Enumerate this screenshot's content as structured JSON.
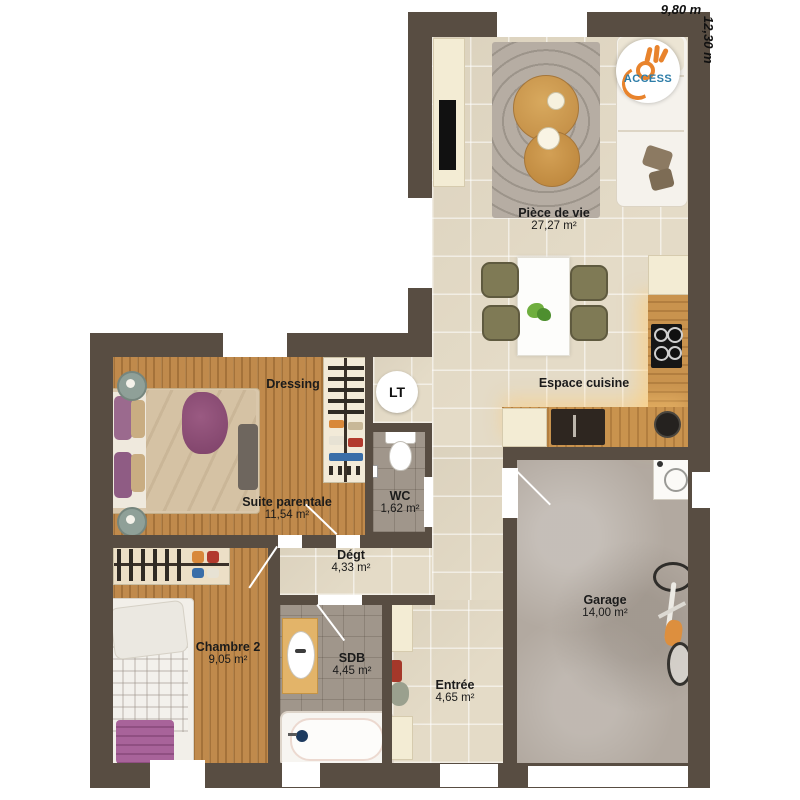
{
  "dimensions": {
    "width_label": "9,80 m",
    "height_label": "12,30 m"
  },
  "logo": {
    "brand": "ACCESS"
  },
  "technical": {
    "lt_label": "LT"
  },
  "rooms": {
    "piece_de_vie": {
      "name": "Pièce de vie",
      "area": "27,27 m²"
    },
    "espace_cuisine": {
      "name": "Espace cuisine"
    },
    "dressing": {
      "name": "Dressing"
    },
    "suite_parentale": {
      "name": "Suite parentale",
      "area": "11,54 m²"
    },
    "wc": {
      "name": "WC",
      "area": "1,62 m²"
    },
    "degagement": {
      "name": "Dégt",
      "area": "4,33 m²"
    },
    "chambre2": {
      "name": "Chambre 2",
      "area": "9,05 m²"
    },
    "sdb": {
      "name": "SDB",
      "area": "4,45 m²"
    },
    "entree": {
      "name": "Entrée",
      "area": "4,65 m²"
    },
    "garage": {
      "name": "Garage",
      "area": "14,00 m²"
    }
  },
  "colors": {
    "wall": "#584d42",
    "tile_floor": "#e4dbc7",
    "wood_floor": "#c08a4c",
    "bath_tile": "#a0968b",
    "concrete": "#b2a9a0",
    "logo_orange": "#e8832c",
    "logo_blue": "#2d7da8"
  }
}
